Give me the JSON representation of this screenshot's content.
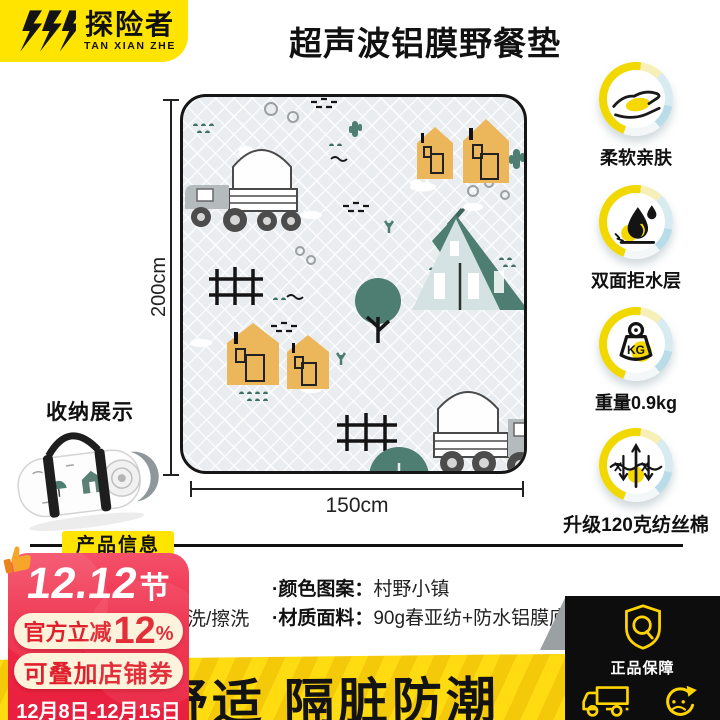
{
  "brand": {
    "name_cn": "探险者",
    "name_en": "TAN XIAN ZHE"
  },
  "title": "超声波铝膜野餐垫",
  "mat": {
    "height_label": "200cm",
    "width_label": "150cm",
    "storage_label": "收纳展示"
  },
  "features": [
    {
      "icon": "hand-touch-icon",
      "label": "柔软亲肤"
    },
    {
      "icon": "water-drop-icon",
      "label": "双面拒水层"
    },
    {
      "icon": "weight-kg-icon",
      "label": "重量0.9kg",
      "icon_text": "KG"
    },
    {
      "icon": "fiber-thread-icon",
      "label": "升级120克纺丝棉"
    }
  ],
  "product_info": {
    "section_title": "产品信息",
    "wash_fragment": "洗/擦洗",
    "rows": [
      {
        "label": "·颜色图案：",
        "value": "村野小镇"
      },
      {
        "label": "·材质面料：",
        "value": "90g春亚纺+防水铝膜底"
      }
    ]
  },
  "promo": {
    "festival_num": "12.12",
    "festival_suffix": "节",
    "discount_prefix": "官方立减",
    "discount_value": "12",
    "discount_suffix": "%",
    "coupon": "可叠加店铺券",
    "date_range": "12月8日-12月15日"
  },
  "banner": {
    "slogan": "舒适 隔脏防潮"
  },
  "guarantee": {
    "items": [
      {
        "icon": "shield-check-icon",
        "label": "正品保障"
      },
      {
        "icon": "delivery-truck-icon",
        "label": "极速发货"
      },
      {
        "icon": "exchange-refresh-icon",
        "label": "破损包换"
      }
    ]
  },
  "colors": {
    "brand_yellow": "#FFE400",
    "banner_yellow": "#FFDB12",
    "promo_red": "#EE2946",
    "promo_text_red": "#E0202C",
    "mat_background": "#E9EDF0",
    "tent_green": "#4E7D72",
    "house_orange": "#ECB75A",
    "icon_accent_yellow": "#F5D800",
    "guarantee_icon_yellow": "#FFD400"
  }
}
